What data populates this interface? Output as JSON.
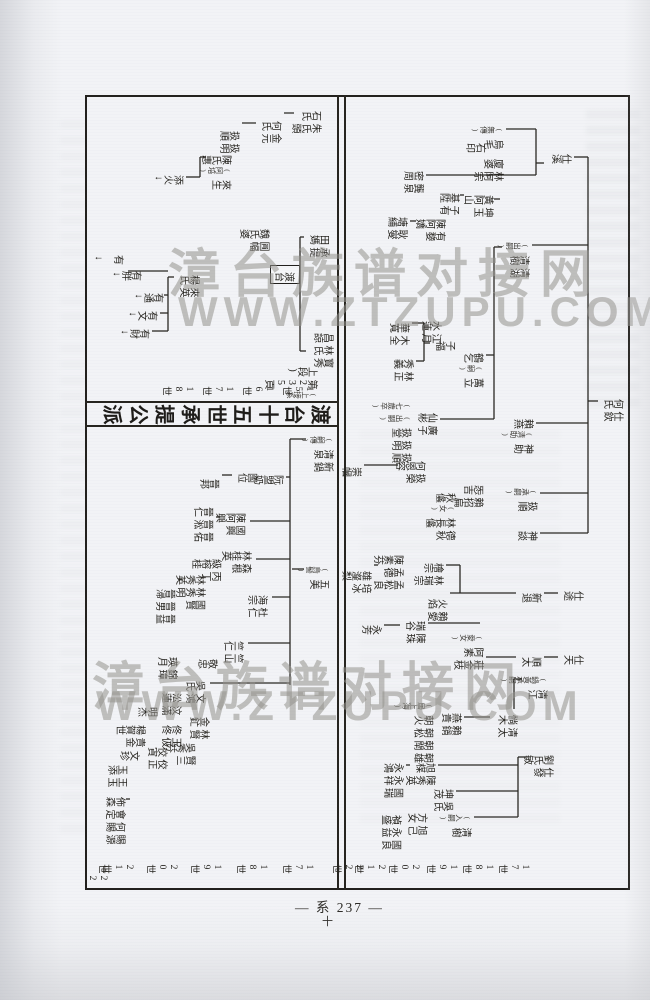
{
  "page": {
    "footer": "— 系 237 —",
    "footer_mark": "十"
  },
  "watermark": {
    "line1": "漳台族谱对接网",
    "line2": "WWW.ZTZUPU.COM"
  },
  "chart": {
    "title_band": {
      "text": "渡台十五世承提公派"
    },
    "continuation_note": "(上接系第235頁上段)",
    "generation_labels": {
      "section_a": {
        "x": 766,
        "items": [
          {
            "t": "17世",
            "y": 100
          },
          {
            "t": "18世",
            "y": 136
          },
          {
            "t": "19世",
            "y": 172
          },
          {
            "t": "20世",
            "y": 210
          },
          {
            "t": "21世",
            "y": 244
          },
          {
            "t": "22世",
            "y": 266
          }
        ]
      },
      "section_b": {
        "x": 288,
        "items": [
          {
            "t": "15世",
            "y": 316
          },
          {
            "t": "16世",
            "y": 356
          },
          {
            "t": "17世",
            "y": 396
          },
          {
            "t": "18世",
            "y": 436
          }
        ]
      },
      "section_c": {
        "x": 766,
        "items": [
          {
            "t": "17世",
            "y": 316
          },
          {
            "t": "18世",
            "y": 362
          },
          {
            "t": "19世",
            "y": 408
          },
          {
            "t": "20世",
            "y": 452
          },
          {
            "t": "21世",
            "y": 496
          },
          {
            "t": "22世",
            "y": 522
          }
        ]
      }
    },
    "nodes": [
      {
        "x": 300,
        "y": 6,
        "cols": [
          "仕欽",
          "何氏"
        ]
      },
      {
        "x": 55,
        "y": 58,
        "cols": [
          "仕溪"
        ]
      },
      {
        "x": 28,
        "y": 126,
        "cols": [
          "烏毛",
          "(無傳)"
        ]
      },
      {
        "x": 44,
        "y": 144,
        "cols": [
          "石印"
        ]
      },
      {
        "x": 60,
        "y": 126,
        "cols": [
          "林阿宗",
          "廈婆"
        ]
      },
      {
        "x": 72,
        "y": 206,
        "cols": [
          "龔泉",
          "密周"
        ]
      },
      {
        "x": 96,
        "y": 136,
        "cols": [
          "坤玉",
          "黃阿山"
        ]
      },
      {
        "x": 94,
        "y": 170,
        "cols": [
          "子有",
          "基陞"
        ]
      },
      {
        "x": 120,
        "y": 184,
        "cols": [
          "有㜈",
          "陳阿嬌"
        ]
      },
      {
        "x": 118,
        "y": 222,
        "cols": [
          "耿燮",
          "塘䋠"
        ]
      },
      {
        "x": 144,
        "y": 100,
        "cols": [
          "清湖",
          "清樹",
          "(出嗣)"
        ]
      },
      {
        "x": 320,
        "y": 96,
        "cols": [
          "神助",
          "(清助)",
          "賴燕"
        ]
      },
      {
        "x": 254,
        "y": 146,
        "cols": [
          "萬立",
          "(嗣)",
          "鶴乞"
        ]
      },
      {
        "x": 242,
        "y": 174,
        "cols": [
          "子福"
        ]
      },
      {
        "x": 222,
        "y": 188,
        "cols": [
          "江月",
          "水蓮"
        ]
      },
      {
        "x": 224,
        "y": 220,
        "cols": [
          "木全",
          "華寬"
        ]
      },
      {
        "x": 260,
        "y": 216,
        "cols": [
          "林正",
          "秀義"
        ]
      },
      {
        "x": 314,
        "y": 192,
        "cols": [
          "廣子",
          "仙彬"
        ]
      },
      {
        "x": 304,
        "y": 218,
        "cols": [
          "扱順",
          "扱明",
          "扱堂",
          "(出嗣)",
          "(七歲卒)"
        ]
      },
      {
        "x": 362,
        "y": 204,
        "cols": [
          "扱榮",
          "何恩容"
        ]
      },
      {
        "x": 368,
        "y": 268,
        "cols": [
          "崇幗"
        ]
      },
      {
        "x": 390,
        "y": 92,
        "cols": [
          "扱順",
          "(承嗣)"
        ]
      },
      {
        "x": 386,
        "y": 146,
        "cols": [
          "賴招扁",
          "㤅吉"
        ]
      },
      {
        "x": 394,
        "y": 174,
        "cols": [
          "德秋",
          "林長㒩",
          "(女)",
          "秋㒩"
        ]
      },
      {
        "x": 432,
        "y": 92,
        "cols": [
          "神談"
        ]
      },
      {
        "x": 492,
        "y": 46,
        "cols": [
          "仕途"
        ]
      },
      {
        "x": 494,
        "y": 88,
        "cols": [
          "新退"
        ]
      },
      {
        "x": 500,
        "y": 182,
        "cols": [
          "賴愛",
          "火焰"
        ]
      },
      {
        "x": 464,
        "y": 186,
        "cols": [
          "林瑞宗",
          "檜宗"
        ]
      },
      {
        "x": 456,
        "y": 226,
        "cols": [
          "孟松良",
          "孟德",
          "陳素芬"
        ]
      },
      {
        "x": 472,
        "y": 258,
        "cols": [
          "培冰",
          "雄瀣梨"
        ]
      },
      {
        "x": 522,
        "y": 204,
        "cols": [
          "陳珠",
          "瑞谷"
        ]
      },
      {
        "x": 526,
        "y": 248,
        "cols": [
          "永芳"
        ]
      },
      {
        "x": 556,
        "y": 46,
        "cols": [
          "仕天"
        ]
      },
      {
        "x": 558,
        "y": 88,
        "cols": [
          "順太"
        ]
      },
      {
        "x": 536,
        "y": 146,
        "cols": [
          "莊金枝",
          "阿素",
          "(愛女)"
        ]
      },
      {
        "x": 578,
        "y": 82,
        "cols": [
          "清江",
          "(鍋黃承嗣)"
        ]
      },
      {
        "x": 616,
        "y": 112,
        "cols": [
          "清太",
          "惝木"
        ]
      },
      {
        "x": 614,
        "y": 168,
        "cols": [
          "賴鍋",
          "燕貴"
        ]
      },
      {
        "x": 604,
        "y": 196,
        "cols": [
          "朝雄",
          "朝閛",
          "朝松",
          "朝火",
          "(居上海)"
        ]
      },
      {
        "x": 664,
        "y": 194,
        "cols": [
          "陳秀英",
          "旭楳"
        ]
      },
      {
        "x": 664,
        "y": 226,
        "cols": [
          "國瑞",
          "永祥",
          "永鴻"
        ]
      },
      {
        "x": 690,
        "y": 176,
        "cols": [
          "吳氏",
          "坤茂"
        ]
      },
      {
        "x": 714,
        "y": 202,
        "cols": [
          "旭己",
          "方女"
        ]
      },
      {
        "x": 716,
        "y": 228,
        "cols": [
          "國良",
          "永益",
          "禎盛"
        ]
      },
      {
        "x": 716,
        "y": 158,
        "cols": [
          "清樹",
          "(入嗣)"
        ]
      },
      {
        "x": 656,
        "y": 76,
        "cols": [
          "仕發",
          "劉氏敏"
        ]
      },
      {
        "x": 234,
        "y": 296,
        "cols": [
          "寳秀",
          "林氏",
          "昌諒"
        ]
      },
      {
        "x": 268,
        "y": 312,
        "cols": [
          "(上接系",
          "第235頁",
          "上段)"
        ]
      },
      {
        "x": 136,
        "y": 300,
        "cols": [
          "承提",
          "田媽"
        ]
      },
      {
        "x": 170,
        "y": 330,
        "cols": [
          "渡台"
        ],
        "box": true
      },
      {
        "x": 130,
        "y": 360,
        "cols": [
          "㘣幅",
          "魏氏婆"
        ]
      },
      {
        "x": 12,
        "y": 308,
        "cols": [
          "朱氏頭",
          "石氏"
        ]
      },
      {
        "x": 22,
        "y": 348,
        "cols": [
          "金元",
          "何氏"
        ]
      },
      {
        "x": 32,
        "y": 390,
        "cols": [
          "扱明",
          "扱順"
        ]
      },
      {
        "x": 56,
        "y": 398,
        "cols": [
          "來生",
          "(阿培)",
          "陳氏惠"
        ]
      },
      {
        "x": 76,
        "y": 446,
        "cols": [
          "添火↓"
        ]
      },
      {
        "x": 176,
        "y": 430,
        "cols": [
          "來英",
          "楊氏"
        ]
      },
      {
        "x": 194,
        "y": 466,
        "cols": [
          "有通↓"
        ]
      },
      {
        "x": 212,
        "y": 472,
        "cols": [
          "有文↓"
        ]
      },
      {
        "x": 230,
        "y": 480,
        "cols": [
          "有財↓"
        ]
      },
      {
        "x": 172,
        "y": 488,
        "cols": [
          "有胖↓"
        ]
      },
      {
        "x": 156,
        "y": 506,
        "cols": [
          "有𡘨↓"
        ]
      },
      {
        "x": 338,
        "y": 296,
        "cols": [
          "新鍋",
          "清泉",
          "(嗣傳)"
        ]
      },
      {
        "x": 376,
        "y": 346,
        "cols": [
          "阮盟奶"
        ]
      },
      {
        "x": 374,
        "y": 372,
        "cols": [
          "國位"
        ]
      },
      {
        "x": 380,
        "y": 410,
        "cols": [
          "晉邦"
        ]
      },
      {
        "x": 414,
        "y": 384,
        "cols": [
          "國興",
          "陳阿興"
        ]
      },
      {
        "x": 408,
        "y": 416,
        "cols": [
          "晉佑",
          "晉淞",
          "晉仁"
        ]
      },
      {
        "x": 452,
        "y": 378,
        "cols": [
          "森根",
          "林桂英"
        ]
      },
      {
        "x": 460,
        "y": 408,
        "cols": [
          "丙丁",
          "級榕桂"
        ]
      },
      {
        "x": 476,
        "y": 424,
        "cols": [
          "國賢",
          "林秀明",
          "林秀英"
        ]
      },
      {
        "x": 490,
        "y": 454,
        "cols": [
          "晉益",
          "晉男",
          "晉㴆"
        ]
      },
      {
        "x": 468,
        "y": 300,
        "cols": [
          "五美",
          "(烏髻)"
        ]
      },
      {
        "x": 496,
        "y": 362,
        "cols": [
          "杜仁",
          "海宗"
        ]
      },
      {
        "x": 542,
        "y": 386,
        "cols": [
          "竺山",
          "竺仁"
        ]
      },
      {
        "x": 560,
        "y": 412,
        "cols": [
          "敬忠"
        ]
      },
      {
        "x": 582,
        "y": 424,
        "cols": [
          "文鴻",
          "吳氏"
        ]
      },
      {
        "x": 558,
        "y": 452,
        "cols": [
          "錦璋",
          "瑛月"
        ]
      },
      {
        "x": 594,
        "y": 448,
        "cols": [
          "汶滿",
          "㳂蓮"
        ]
      },
      {
        "x": 618,
        "y": 420,
        "cols": [
          "林賢",
          "金釯"
        ]
      },
      {
        "x": 626,
        "y": 448,
        "cols": [
          "玉伋",
          "佟佟"
        ]
      },
      {
        "x": 644,
        "y": 434,
        "cols": [
          "賢三",
          "吳秀芬"
        ]
      },
      {
        "x": 648,
        "y": 462,
        "cols": [
          "佼正",
          "佼寊"
        ]
      },
      {
        "x": 608,
        "y": 472,
        "cols": [
          "明杰"
        ]
      },
      {
        "x": 626,
        "y": 484,
        "cols": [
          "貴金",
          "楊賀世"
        ]
      },
      {
        "x": 652,
        "y": 490,
        "cols": [
          "文珍"
        ]
      },
      {
        "x": 666,
        "y": 502,
        "cols": [
          "王玉",
          "玉添"
        ]
      },
      {
        "x": 698,
        "y": 504,
        "cols": [
          "賜源",
          "何賜",
          "會定",
          "佈森"
        ]
      }
    ],
    "segments": [
      [
        306,
        32,
        306,
        42
      ],
      [
        62,
        42,
        438,
        42
      ],
      [
        62,
        42,
        62,
        56
      ],
      [
        150,
        42,
        150,
        98
      ],
      [
        328,
        42,
        328,
        94
      ],
      [
        398,
        42,
        398,
        90
      ],
      [
        438,
        42,
        438,
        90
      ],
      [
        68,
        86,
        68,
        94
      ],
      [
        34,
        94,
        80,
        94
      ],
      [
        34,
        94,
        34,
        124
      ],
      [
        80,
        94,
        80,
        204
      ],
      [
        152,
        128,
        152,
        136
      ],
      [
        152,
        136,
        324,
        136
      ],
      [
        260,
        136,
        260,
        144
      ],
      [
        324,
        136,
        324,
        190
      ],
      [
        104,
        130,
        104,
        136
      ],
      [
        100,
        166,
        100,
        170
      ],
      [
        126,
        214,
        126,
        220
      ],
      [
        248,
        200,
        248,
        206
      ],
      [
        228,
        206,
        266,
        206
      ],
      [
        228,
        206,
        228,
        218
      ],
      [
        266,
        206,
        266,
        214
      ],
      [
        370,
        232,
        370,
        266
      ],
      [
        498,
        72,
        498,
        86
      ],
      [
        498,
        114,
        498,
        180
      ],
      [
        470,
        170,
        498,
        170
      ],
      [
        470,
        170,
        470,
        184
      ],
      [
        470,
        252,
        470,
        256
      ],
      [
        528,
        150,
        528,
        202
      ],
      [
        530,
        230,
        530,
        246
      ],
      [
        562,
        72,
        562,
        86
      ],
      [
        562,
        114,
        562,
        144
      ],
      [
        584,
        108,
        584,
        116
      ],
      [
        584,
        116,
        614,
        116
      ],
      [
        622,
        140,
        622,
        166
      ],
      [
        662,
        104,
        662,
        112
      ],
      [
        662,
        112,
        722,
        112
      ],
      [
        670,
        112,
        670,
        192
      ],
      [
        696,
        112,
        696,
        174
      ],
      [
        722,
        112,
        722,
        156
      ],
      [
        670,
        220,
        670,
        224
      ],
      [
        18,
        336,
        18,
        346
      ],
      [
        28,
        374,
        28,
        388
      ],
      [
        62,
        424,
        62,
        430
      ],
      [
        62,
        430,
        82,
        430
      ],
      [
        82,
        430,
        82,
        444
      ],
      [
        142,
        326,
        142,
        330
      ],
      [
        256,
        324,
        256,
        330
      ],
      [
        142,
        330,
        256,
        330
      ],
      [
        182,
        456,
        182,
        462
      ],
      [
        182,
        462,
        236,
        462
      ],
      [
        200,
        462,
        200,
        466
      ],
      [
        218,
        462,
        218,
        470
      ],
      [
        236,
        462,
        236,
        478
      ],
      [
        176,
        462,
        176,
        484
      ],
      [
        176,
        484,
        176,
        502
      ],
      [
        344,
        324,
        344,
        340
      ],
      [
        344,
        340,
        590,
        340
      ],
      [
        382,
        340,
        382,
        344
      ],
      [
        380,
        398,
        380,
        408
      ],
      [
        426,
        340,
        426,
        380
      ],
      [
        464,
        340,
        464,
        374
      ],
      [
        502,
        340,
        502,
        358
      ],
      [
        548,
        340,
        548,
        382
      ],
      [
        588,
        340,
        588,
        420
      ],
      [
        422,
        410,
        422,
        414
      ],
      [
        484,
        448,
        484,
        452
      ],
      [
        704,
        500,
        704,
        504
      ],
      [
        474,
        326,
        474,
        338
      ]
    ]
  }
}
